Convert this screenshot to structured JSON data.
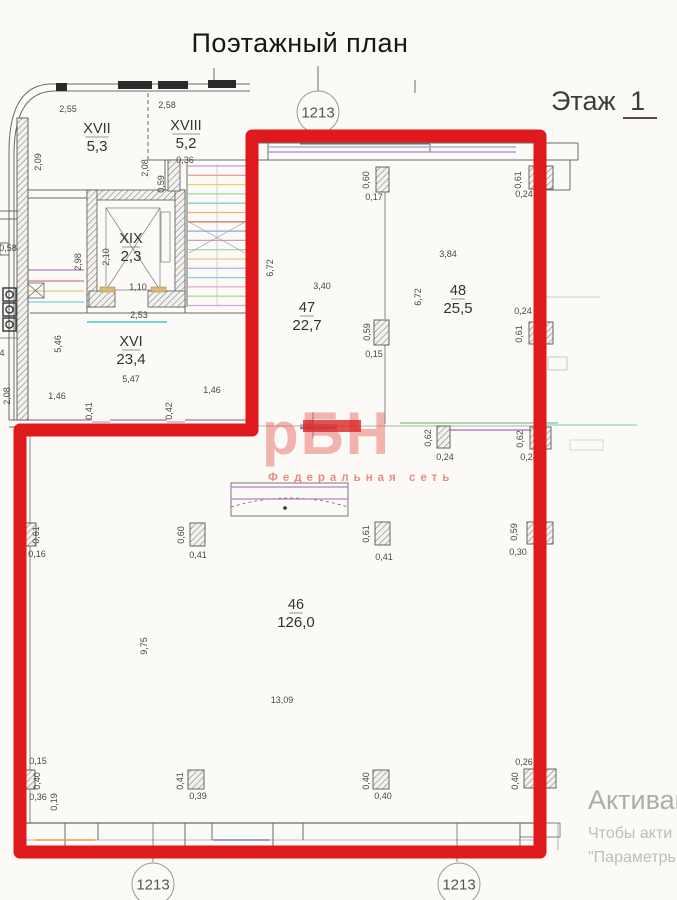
{
  "title": "Поэтажный план",
  "floor": {
    "label": "Этаж",
    "number": "1"
  },
  "watermark": {
    "logo": "рБН",
    "subtitle": "Федеральная сеть",
    "color": "#e4524c"
  },
  "activation": {
    "line1": "Активац",
    "line2": "Чтобы акти",
    "line3": "\"Параметрь"
  },
  "red_outline_color": "#e0191d",
  "axis_markers": [
    {
      "label": "1213",
      "x": 318,
      "y": 112
    },
    {
      "label": "1213",
      "x": 153,
      "y": 884
    },
    {
      "label": "1213",
      "x": 459,
      "y": 884
    }
  ],
  "rooms": [
    {
      "number": "XVII",
      "area": "5,3",
      "x": 97,
      "y": 133
    },
    {
      "number": "XVIII",
      "area": "5,2",
      "x": 186,
      "y": 130
    },
    {
      "number": "XIX",
      "area": "2,3",
      "x": 131,
      "y": 243
    },
    {
      "number": "XVI",
      "area": "23,4",
      "x": 131,
      "y": 346
    },
    {
      "number": "47",
      "area": "22,7",
      "x": 307,
      "y": 312
    },
    {
      "number": "48",
      "area": "25,5",
      "x": 458,
      "y": 295
    },
    {
      "number": "46",
      "area": "126,0",
      "x": 296,
      "y": 609
    }
  ],
  "plan": {
    "line_color": "#6a6a6a",
    "dim_color": "#474747",
    "dims": [
      [
        "2,55",
        68,
        112,
        0
      ],
      [
        "2,58",
        167,
        108,
        0
      ],
      [
        "0,36",
        185,
        163,
        0
      ],
      [
        "1,10",
        138,
        290,
        0
      ],
      [
        "2,53",
        139,
        318,
        0
      ],
      [
        "5,47",
        131,
        382,
        0
      ],
      [
        "1,46",
        57,
        399,
        0
      ],
      [
        "1,46",
        212,
        393,
        0
      ],
      [
        "0,17",
        374,
        200,
        0
      ],
      [
        "0,24",
        524,
        197,
        0
      ],
      [
        "3,40",
        322,
        289,
        0
      ],
      [
        "3,84",
        448,
        257,
        0
      ],
      [
        "0,15",
        374,
        357,
        0
      ],
      [
        "0,24",
        523,
        314,
        0
      ],
      [
        "0,24",
        445,
        460,
        0
      ],
      [
        "0,24",
        529,
        460,
        0
      ],
      [
        "0,16",
        37,
        557,
        0
      ],
      [
        "0,41",
        198,
        558,
        0
      ],
      [
        "0,41",
        384,
        560,
        0
      ],
      [
        "0,30",
        518,
        555,
        0
      ],
      [
        "13,09",
        282,
        703,
        0
      ],
      [
        "0,15",
        38,
        764,
        0
      ],
      [
        "0,36",
        38,
        800,
        0
      ],
      [
        "0,39",
        198,
        799,
        0
      ],
      [
        "0,40",
        383,
        799,
        0
      ],
      [
        "0,26",
        524,
        765,
        0
      ],
      [
        "0,58",
        8,
        251,
        0
      ],
      [
        "4",
        2,
        356,
        0
      ],
      [
        "2,09",
        41,
        162,
        1
      ],
      [
        "2,08",
        148,
        168,
        1
      ],
      [
        "0,59",
        164,
        184,
        1
      ],
      [
        "2,10",
        109,
        257,
        1
      ],
      [
        "2,98",
        81,
        262,
        1
      ],
      [
        "5,46",
        61,
        344,
        1
      ],
      [
        "0,41",
        92,
        411,
        1
      ],
      [
        "0,42",
        172,
        411,
        1
      ],
      [
        "2,08",
        10,
        396,
        1
      ],
      [
        "0,60",
        369,
        180,
        1
      ],
      [
        "0,61",
        521,
        180,
        1
      ],
      [
        "6,72",
        273,
        268,
        1
      ],
      [
        "6,72",
        421,
        297,
        1
      ],
      [
        "0,59",
        370,
        332,
        1
      ],
      [
        "0,61",
        522,
        334,
        1
      ],
      [
        "0,62",
        431,
        438,
        1
      ],
      [
        "0,62",
        523,
        439,
        1
      ],
      [
        "0,61",
        39,
        535,
        1
      ],
      [
        "0,60",
        184,
        535,
        1
      ],
      [
        "0,61",
        369,
        534,
        1
      ],
      [
        "0,59",
        517,
        532,
        1
      ],
      [
        "9,75",
        147,
        646,
        1
      ],
      [
        "0,40",
        40,
        781,
        1
      ],
      [
        "0,19",
        57,
        802,
        1
      ],
      [
        "0,41",
        183,
        781,
        1
      ],
      [
        "0,40",
        369,
        781,
        1
      ],
      [
        "0,40",
        518,
        781,
        1
      ]
    ],
    "piers": [
      [
        17,
        118,
        11,
        302
      ],
      [
        376,
        167,
        13,
        25
      ],
      [
        529,
        166,
        24,
        23
      ],
      [
        374,
        320,
        15,
        25
      ],
      [
        529,
        322,
        24,
        22
      ],
      [
        437,
        426,
        13,
        22
      ],
      [
        530,
        427,
        21,
        22
      ],
      [
        22,
        523,
        14,
        23
      ],
      [
        190,
        523,
        15,
        23
      ],
      [
        375,
        522,
        15,
        23
      ],
      [
        527,
        522,
        26,
        22
      ],
      [
        21,
        770,
        14,
        19
      ],
      [
        188,
        770,
        16,
        19
      ],
      [
        373,
        770,
        16,
        19
      ],
      [
        524,
        769,
        32,
        19
      ]
    ],
    "stair": {
      "x1": 188,
      "x2": 246,
      "y": 166,
      "dy": 9.3,
      "colors": [
        "#b8a0d8",
        "#e8a0a8",
        "#e8d06a",
        "#9ed89a",
        "#7ecfd4",
        "#f0b070",
        "#d87a7a",
        "#8aa8e0",
        "#d898c8",
        "#a8d8c0",
        "#e8c4a0",
        "#c0b4e4",
        "#90c8e8",
        "#e8a8c8",
        "#b0d890",
        "#caa6dc"
      ]
    },
    "colored_lines": [
      [
        268,
        147,
        516,
        "#9cb8dc",
        1.4
      ],
      [
        268,
        152,
        516,
        "#b481c6",
        1.2
      ],
      [
        28,
        270,
        84,
        "#b481c6",
        1.2
      ],
      [
        28,
        281,
        84,
        "#d87a7a",
        1.2
      ],
      [
        28,
        291,
        84,
        "#dcd07a",
        1.2
      ],
      [
        28,
        302,
        84,
        "#7ecfd4",
        1.2
      ],
      [
        400,
        423,
        558,
        "#8fd08f",
        1.4
      ],
      [
        443,
        430,
        537,
        "#b481c6",
        1.4
      ],
      [
        300,
        428,
        337,
        "#6f8ccd",
        2.6
      ],
      [
        231,
        487,
        348,
        "#b481c6",
        1.2
      ],
      [
        231,
        499,
        348,
        "#b481c6",
        1.2
      ],
      [
        35,
        840,
        95,
        "#e0a050",
        1.4
      ],
      [
        213,
        840,
        270,
        "#7088c8",
        1.4
      ],
      [
        545,
        425,
        637,
        "#9adbd4",
        1.4
      ],
      [
        87,
        322,
        167,
        "#7ecfd4",
        2
      ],
      [
        545,
        297,
        600,
        "#c9c9c9",
        1
      ]
    ]
  }
}
